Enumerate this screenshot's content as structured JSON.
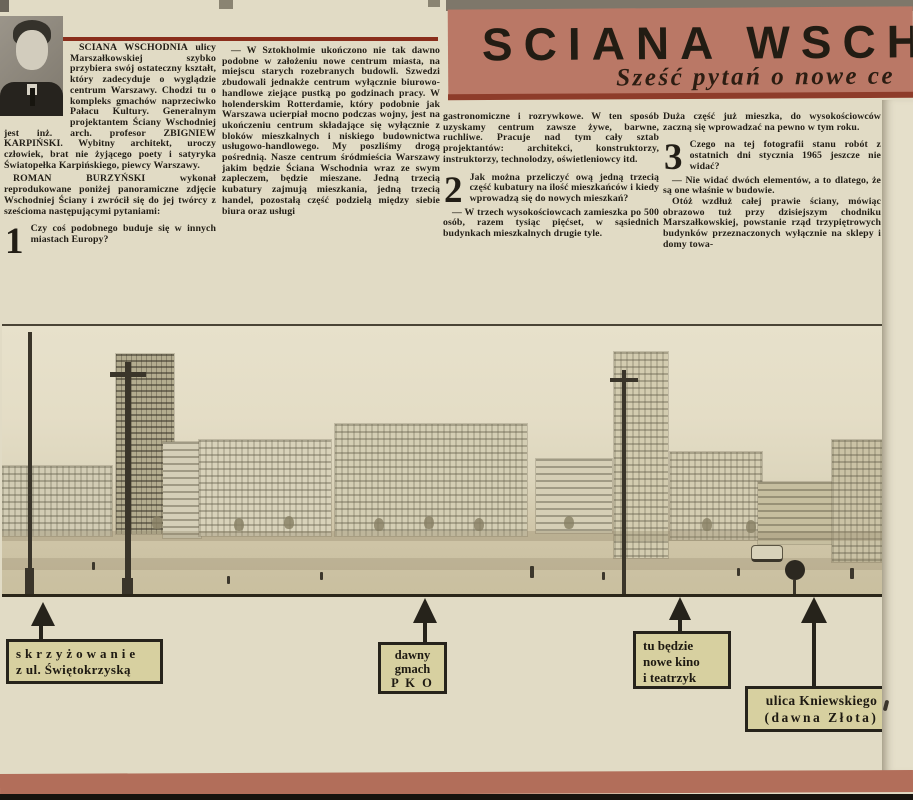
{
  "masthead": {
    "title": "SCIANA WSCHODNIA",
    "subtitle": "Sześć pytań o nowe ce"
  },
  "article": {
    "col1": {
      "lead": "ŚCIANA WSCHODNIA ulicy Marszałkowskiej szybko przybiera swój ostateczny kształt, który zadecyduje o wyglądzie centrum Warszawy. Chodzi tu o kompleks gmachów naprzeciwko Pałacu Kultury. Generalnym projektantem Ściany Wschodniej jest inż. arch. profesor ZBIGNIEW KARPIŃSKI. Wybitny architekt, uroczy człowiek, brat nie żyjącego poety i satyryka Światopełka Karpińskiego, piewcy Warszawy.",
      "p2": "ROMAN BURZYŃSKI wykonał reprodukowane poniżej panoramiczne zdjęcie Wschodniej Ściany i zwrócił się do jej twórcy z sześcioma następującymi pytaniami:",
      "q1_num": "1",
      "q1": "Czy coś podobnego buduje się w innych miastach Europy?"
    },
    "col2": {
      "p1": "— W Sztokholmie ukończono nie tak dawno podobne w założeniu nowe centrum miasta, na miejscu starych rozebranych budowli. Szwedzi zbudowali jednakże centrum wyłącznie biurowo-handlowe ziejące pustką po godzinach pracy. W holenderskim Rotterdamie, który podobnie jak Warszawa ucierpiał mocno podczas wojny, jest na ukończeniu centrum składające się wyłącznie z bloków mieszkalnych i niskiego budownictwa usługowo-handlowego. My poszliśmy drogą pośrednią. Nasze centrum śródmieścia Warszawy jakim będzie Ściana Wschodnia wraz ze swym zapleczem, będzie mieszane. Jedną trzecią kubatury zajmują mieszkania, jedną trzecią handel, pozostałą część podzielą między siebie biura oraz usługi"
    },
    "col3": {
      "p1": "gastronomiczne i rozrywkowe. W ten sposób uzyskamy centrum zawsze żywe, barwne, ruchliwe. Pracuje nad tym cały sztab projektantów: architekci, konstruktorzy, instruktorzy, technolodzy, oświetleniowcy itd.",
      "q2_num": "2",
      "q2": "Jak można przeliczyć ową jedną trzecią część kubatury na ilość mieszkańców i kiedy wprowadzą się do nowych mieszkań?",
      "p2": "— W trzech wysokościowcach zamieszka po 500 osób, razem tysiąc pięćset, w sąsiednich budynkach mieszkalnych drugie tyle."
    },
    "col4": {
      "p1": "Duża część już mieszka, do wysokościowców zaczną się wprowadzać na pewno w tym roku.",
      "q3_num": "3",
      "q3": "Czego na tej fotografii stanu robót z ostatnich dni stycznia 1965 jeszcze nie widać?",
      "p2": "— Nie widać dwóch elementów, a to dlatego, że są one właśnie w budowie.",
      "p3": "Otóż wzdłuż całej prawie ściany, mówiąc obrazowo tuż przy dzisiejszym chodniku Marszałkowskiej, powstanie rząd trzypiętrowych budynków przeznaczonych wyłącznie na sklepy i domy towa-"
    }
  },
  "callouts": [
    {
      "lines": [
        "skrzyżowanie",
        "z ul. Świętokrzyską"
      ]
    },
    {
      "lines": [
        "dawny",
        "gmach",
        "P K O"
      ]
    },
    {
      "lines": [
        "tu będzie",
        "nowe kino",
        "i teatrzyk"
      ]
    },
    {
      "lines": [
        "ulica Kniewskiego",
        "(dawna Złota)"
      ]
    }
  ],
  "colors": {
    "paper": "#e1dbc5",
    "masthead_band": "#ba7866",
    "masthead_rule": "#8e3c2a",
    "column_rule": "#8a2e1c",
    "callout_bg": "#d7d0a0",
    "callout_border": "#26231b",
    "bottom_band": "#b26e5a",
    "bottom_edge": "#17130e"
  }
}
